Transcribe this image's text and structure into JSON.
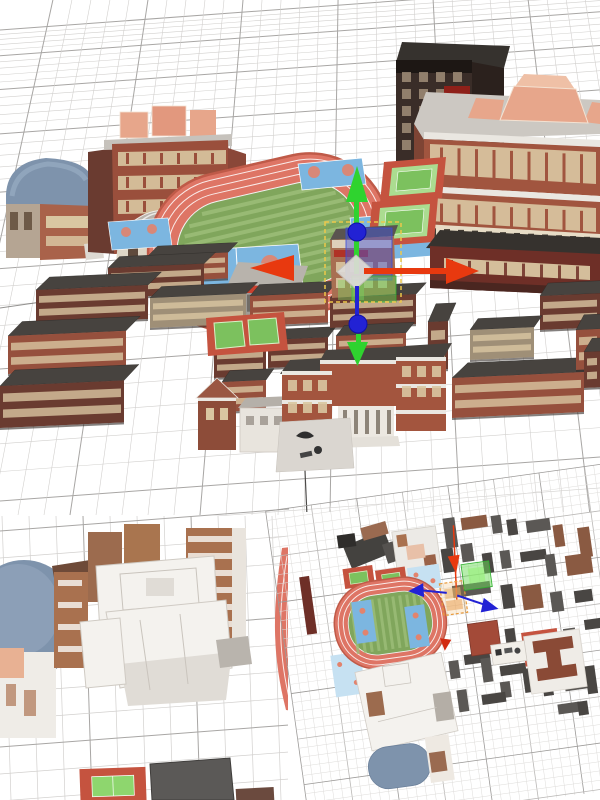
{
  "scene": {
    "type": "3d-editor-viewport",
    "viewports": {
      "main": "perspective",
      "detail": "closeup",
      "top": "plan"
    }
  },
  "gizmo": {
    "x_axis": "red",
    "y_axis": "green",
    "z_axis": "blue",
    "selection": "yellow-dashed"
  },
  "colors": {
    "bg": "#ffffff",
    "gridFine": "#d2d0ce",
    "gridMajor": "#a8a6a4",
    "gridAxis": "#4c4a48",
    "tgridFine": "#dedcda",
    "tgridMajor": "#bab8b6",
    "roof": "#47433f",
    "roofDark": "#36322e",
    "brick": "#96503d",
    "brickDark": "#6a3b30",
    "maroon": "#6e2f27",
    "tan": "#9f8f77",
    "cream": "#d9c6a1",
    "trim": "#eae7e1",
    "track": "#de7565",
    "trackEdge": "#bf5a48",
    "field": "#80a65c",
    "stripe": "#9dbe79",
    "courtBlue": "#7cb6e0",
    "courtPale": "#c6e1f2",
    "courtMark": "#e2836d",
    "tcRed": "#c5533f",
    "tcGreen": "#7cc15e",
    "tcLight": "#abdc90",
    "slate": "#7e93ac",
    "slateHi": "#9db0c6",
    "dome": "#b8b3ac",
    "whiteModel": "#f4f2ee",
    "whiteShade": "#e0dcd6",
    "whiteLine": "#c9c4bd",
    "salmon": "#e7a68b",
    "salmonHi": "#efc0a6",
    "office": "#a1553f",
    "tower": "#3a2d28",
    "towerSide": "#2b211d",
    "towerWin": "#b7a289",
    "sign": "#8e2019",
    "gred": "#e8390f",
    "ggreen": "#2fd32f",
    "gblue": "#2222d4",
    "gwhite": "#dedcd8",
    "sel": "#ecc84a",
    "selBlue": "rgba(64,86,226,0.45)",
    "selGreen": "rgba(96,206,84,0.5)",
    "selOrange": "#e89a3c",
    "gray1": "#5b5855",
    "gray2": "#494643",
    "brown": "#8a5a42"
  }
}
